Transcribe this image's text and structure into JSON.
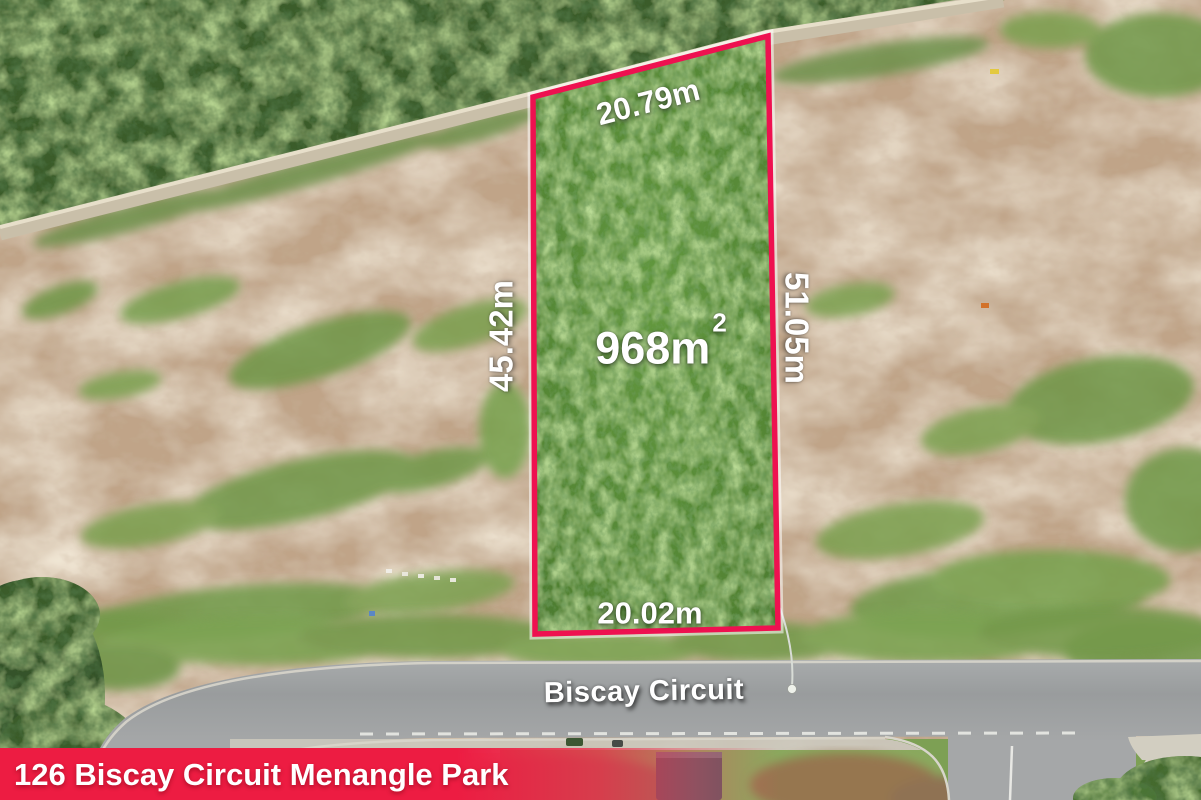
{
  "photo": {
    "description": "aerial drone photo of vacant land lot for sale",
    "labels": {
      "dim_top": "20.79m",
      "dim_left": "45.42m",
      "dim_right": "51.05m",
      "dim_bottom": "20.02m",
      "area_value": "968m",
      "area_exponent": "2",
      "street_name": "Biscay Circuit"
    },
    "banner": {
      "address": "126 Biscay Circuit Menangle Park"
    },
    "colors": {
      "lot_outline": "#ee1150",
      "banner_red": "#ed1c42",
      "lot_grass": "#538434",
      "dirt": "#c0a488",
      "road": "#9da0a1"
    }
  }
}
